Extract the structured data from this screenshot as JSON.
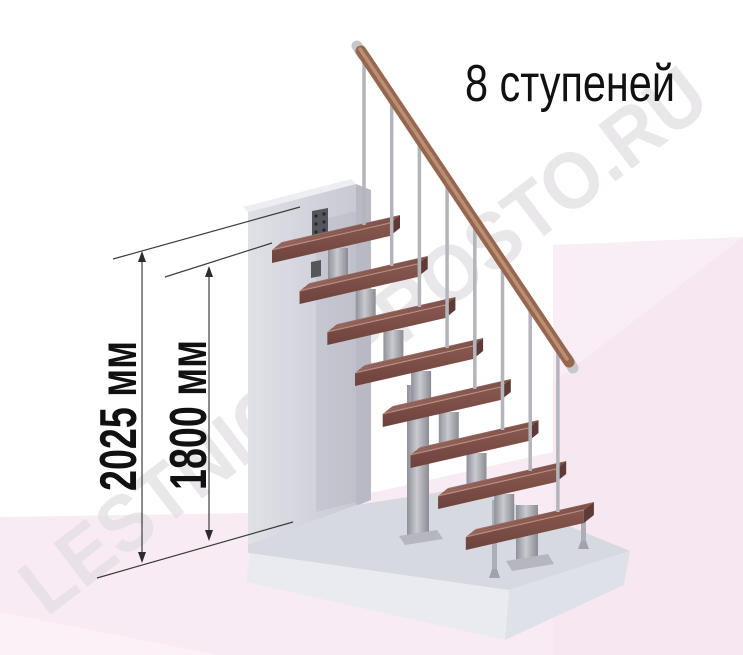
{
  "title": "8 ступеней",
  "steps_count": 8,
  "dimension_labels": [
    "2025 мм",
    "1800 мм"
  ],
  "watermark": "LESTNICA-PROSTO.RU",
  "colors": {
    "background": "#ffffff",
    "floor_pink": "#f8ebf3",
    "panel_pink_light": "#f9eef6",
    "panel_pink_deep": "#f7e7f0",
    "floor_pink_pale": "#fbf2f8",
    "wood_top_light": "#a4736a",
    "wood_top_dark": "#8a5a52",
    "wood_front": "#7a4d46",
    "wood_end": "#5f3b37",
    "handrail": "#96674f",
    "handrail_highlight": "#c59a7e",
    "metal_light": "#c9c9cf",
    "metal_mid": "#a8a8af",
    "baluster": "#b4b4bb",
    "wall_light": "#e0e0e7",
    "wall_dark": "#c9c9d3",
    "wall_top": "#eceef2",
    "wall_side": "#b9b9c3",
    "plate": "#54565c",
    "platform_top": "#d7d9e1",
    "platform_front": "#e9ebf0",
    "platform_side": "#dfe1e9",
    "dimension_line": "#3c3c3c",
    "watermark_color": "#e3dfe4"
  }
}
